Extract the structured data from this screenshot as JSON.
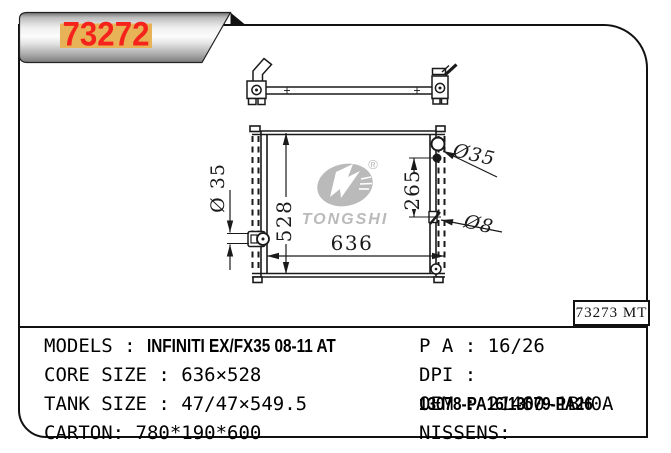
{
  "banner": {
    "part_number": "73272",
    "label_bg": "#e8b357",
    "number_color": "#f5231c"
  },
  "drawing": {
    "dim_height": "528",
    "dim_width": "636",
    "dim_inlet_span": "265",
    "dim_left_pipe": "Ø 35",
    "dim_filler_pipe": "Ø35",
    "dim_drain_pipe": "Ø8",
    "ref_label": "73273 MT"
  },
  "watermark": {
    "brand": "TONGSHI",
    "registered_mark": "®",
    "color": "#bababa"
  },
  "specs": {
    "left": [
      {
        "label": "MODELS : ",
        "value": "INFINITI EX/FX35 08-11 AT"
      },
      {
        "label": "CORE SIZE : ",
        "value": "636×528"
      },
      {
        "label": "TANK SIZE : ",
        "value": "47/47×549.5"
      },
      {
        "label": "CARTON: ",
        "value": "780*190*600"
      }
    ],
    "right": [
      {
        "label": "P A : ",
        "value": "16/26"
      },
      {
        "label": "DPI :",
        "value": "13078-PA16/13079-PA26"
      },
      {
        "label": "OEM : ",
        "value": "21460-1BH0A"
      },
      {
        "label": "NISSENS:",
        "value": ""
      }
    ]
  }
}
